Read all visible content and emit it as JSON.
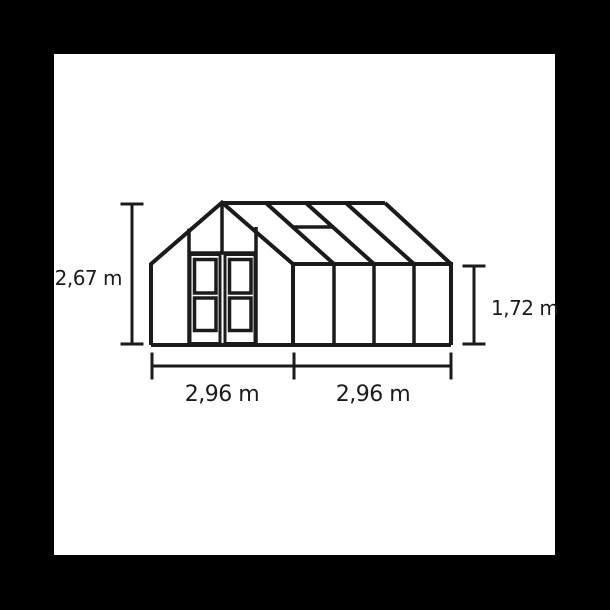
{
  "figure": {
    "type": "technical-diagram",
    "subject": "Greenhouse elevation drawing: gable end with double doors, four-panel side wall, roof with vent window, annotated with dimension lines",
    "dimensions": {
      "left_height_label": "2,67 m",
      "right_height_label": "1,72 m",
      "bottom_left_width_label": "2,96 m",
      "bottom_right_width_label": "2,96 m"
    },
    "colors": {
      "line": "#1b1b1b",
      "background": "#ffffff",
      "frame": "#000000"
    }
  }
}
